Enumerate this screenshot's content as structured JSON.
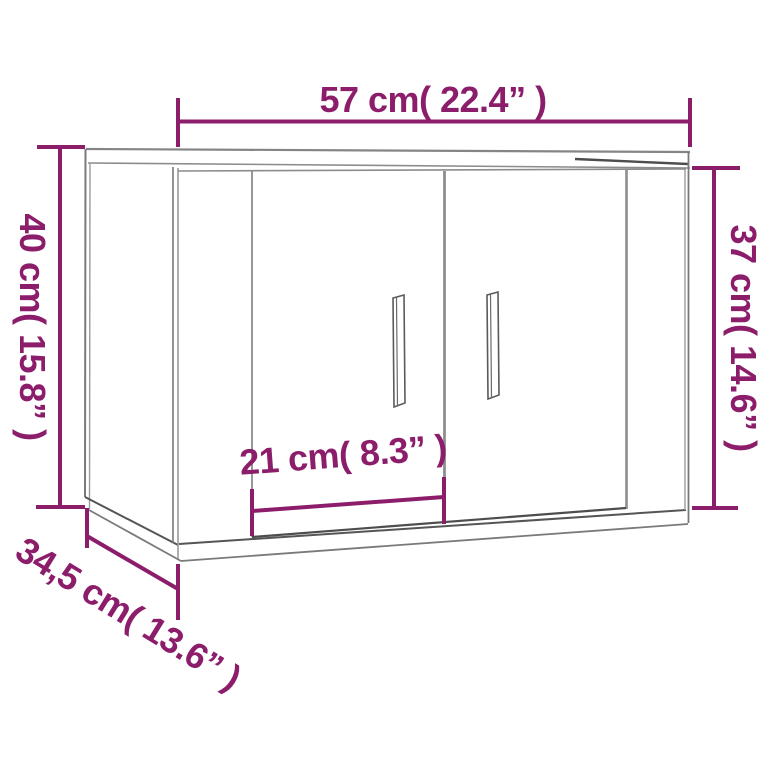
{
  "diagram": {
    "type": "furniture-dimension-diagram",
    "subject": "wall-mounted cabinet with two doors, 3d line drawing",
    "accent_color": "#8C1D6B",
    "line_color": "#7A7A7A",
    "dark_line_color": "#4D4D4D",
    "background_color": "#FFFFFF",
    "dimensions": {
      "width": {
        "label": "57 cm( 22.4” )",
        "cm": "57",
        "inch": "22.4"
      },
      "height_left": {
        "label": "40 cm( 15.8” )",
        "cm": "40",
        "inch": "15.8"
      },
      "height_right": {
        "label": "37 cm( 14.6” )",
        "cm": "37",
        "inch": "14.6"
      },
      "door_width": {
        "label": "21 cm( 8.3” )",
        "cm": "21",
        "inch": "8.3"
      },
      "depth": {
        "label": "34,5 cm( 13.6” )",
        "cm": "34,5",
        "inch": "13.6"
      }
    }
  }
}
